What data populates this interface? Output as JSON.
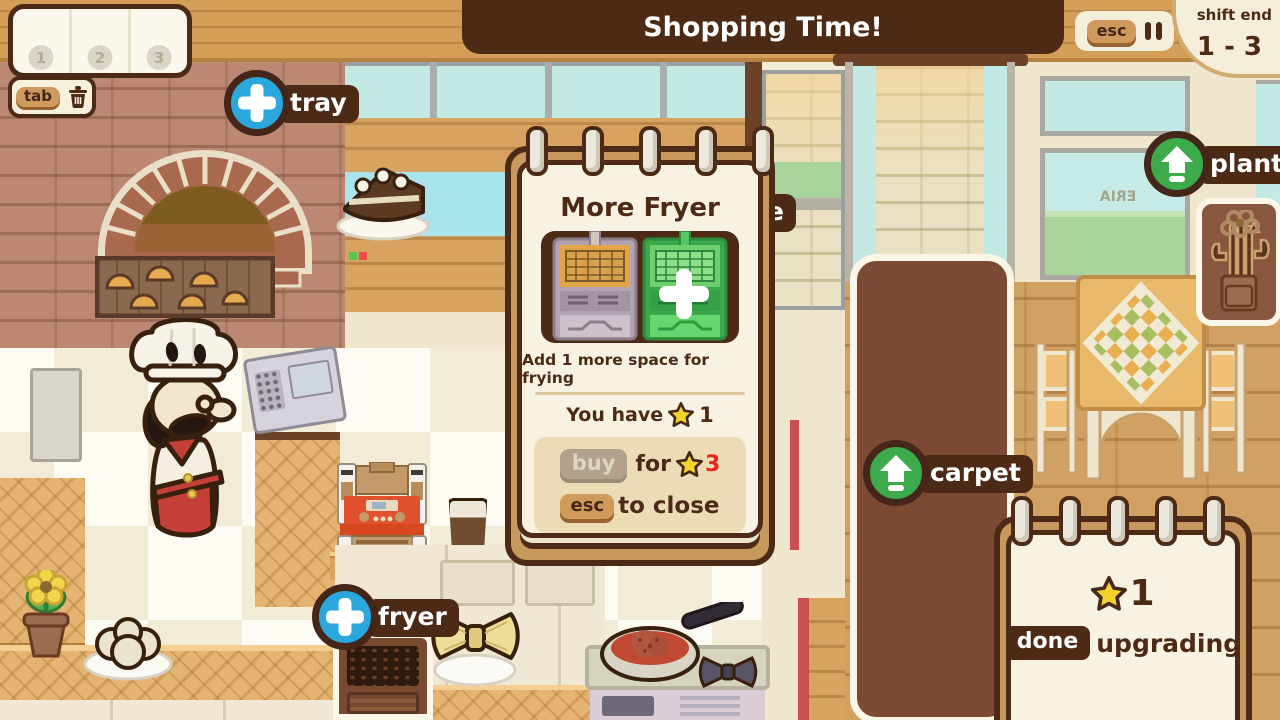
{
  "header": {
    "banner": "Shopping Time!",
    "esc_key": "esc",
    "shift_end_label": "shift end",
    "shift_range": "1 - 3"
  },
  "tray_bar": {
    "slot_numbers": [
      "1",
      "2",
      "3"
    ],
    "tab_key": "tab"
  },
  "upgrade_labels": {
    "tray": "tray",
    "fryer": "fryer",
    "plant": "plant",
    "carpet": "carpet",
    "partial_table": "le"
  },
  "popup": {
    "title": "More Fryer",
    "description": "Add 1 more space for frying",
    "you_have_label": "You have",
    "you_have_count": "1",
    "buy_key": "buy",
    "for_label": "for",
    "cost": "3",
    "esc_key": "esc",
    "close_label": "to close"
  },
  "done_note": {
    "star_count": "1",
    "done_key": "done",
    "action_label": "upgrading"
  },
  "decor": {
    "window_sign": "ERIA"
  },
  "colors": {
    "dark_brown": "#4c2a16",
    "accent_blue": "#2ba7dd",
    "accent_green": "#3dab4b",
    "star_yellow": "#f6d32b",
    "cost_red": "#e7251b",
    "page_cream": "#f8f2e2",
    "backing_tan": "#c8995e"
  }
}
